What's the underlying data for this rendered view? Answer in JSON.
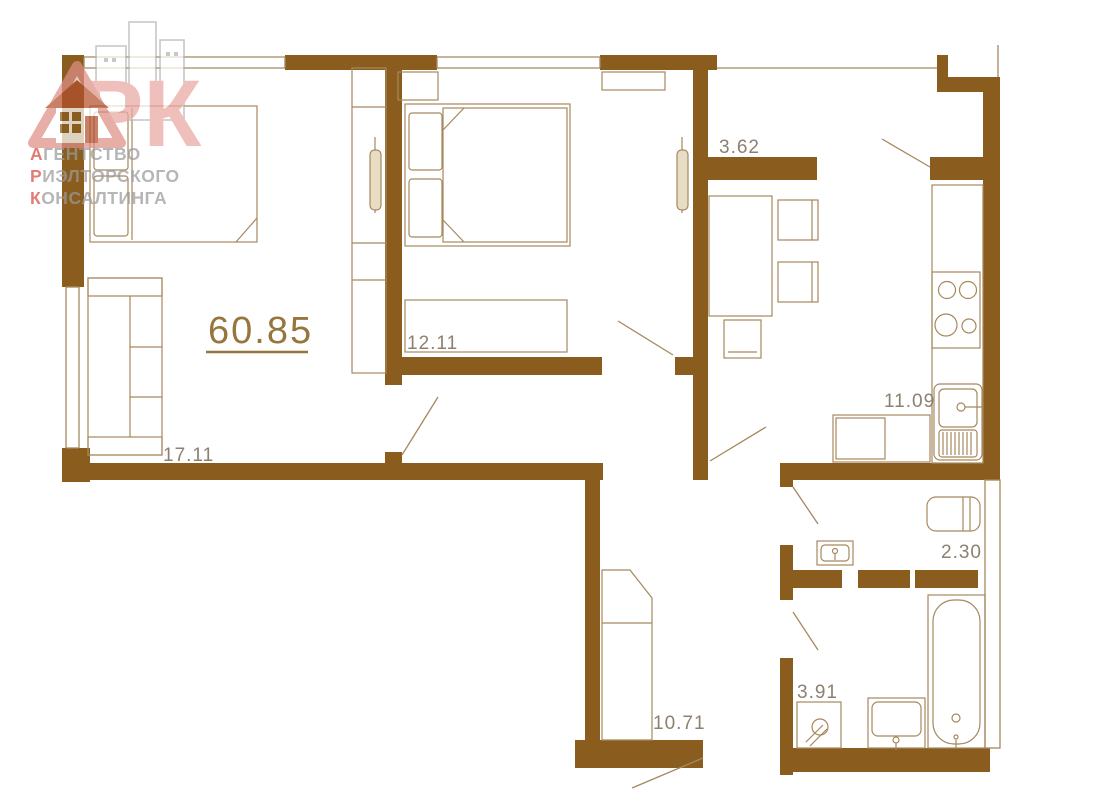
{
  "meta": {
    "type": "apartment-floor-plan",
    "description": "2-room apartment floor plan with furniture"
  },
  "logo": {
    "acronym": "АРК",
    "big_letters": "РК",
    "lines": [
      {
        "initial": "А",
        "rest": "ГЕНТСТВО"
      },
      {
        "initial": "Р",
        "rest": "ИЭЛТОРСКОГО"
      },
      {
        "initial": "К",
        "rest": "ОНСАЛТИНГА"
      }
    ]
  },
  "plan": {
    "total_area": "60.85",
    "rooms": [
      {
        "name": "living-room",
        "area": "17.11"
      },
      {
        "name": "bedroom",
        "area": "12.11"
      },
      {
        "name": "hallway",
        "area": "3.62"
      },
      {
        "name": "kitchen",
        "area": "11.09"
      },
      {
        "name": "wc",
        "area": "2.30"
      },
      {
        "name": "bathroom",
        "area": "3.91"
      },
      {
        "name": "corridor",
        "area": "10.71"
      }
    ]
  },
  "colors": {
    "wall": "#8a5d1e",
    "furniture_line": "#a5895e",
    "room_label": "#8d8071",
    "total_label": "#96763d",
    "logo_red": "#d84a42",
    "logo_pink": "#e9a8a1",
    "logo_gray": "#9b9b9b"
  }
}
